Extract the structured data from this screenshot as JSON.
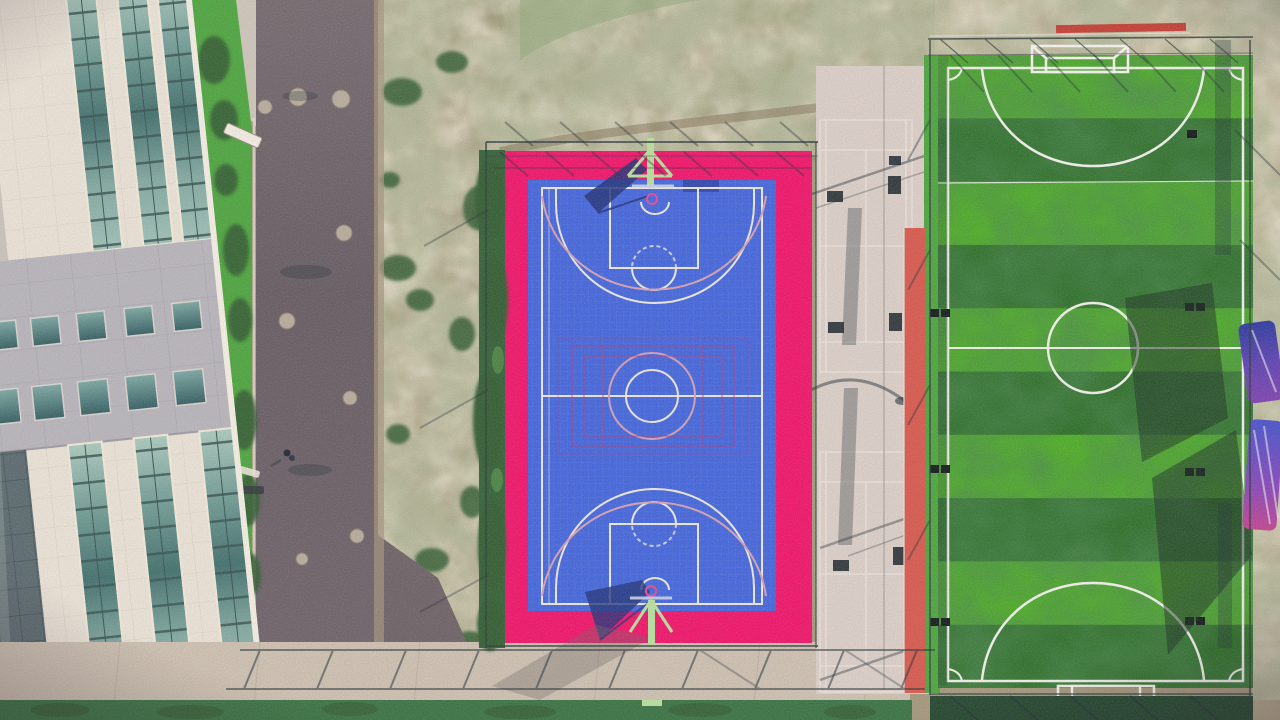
{
  "scene": {
    "description-regions": [
      "office-building",
      "access-road",
      "scrub-ground",
      "basketball-court",
      "badminton-strip",
      "soccer-field"
    ],
    "text_content": "none"
  },
  "colors": {
    "scrub-tan": "#a2967a",
    "scrub-olive": "#90906b",
    "dirt-light": "#b3a68a",
    "pavement-light": "#cdc5b8",
    "concrete-walk": "#c9bcab",
    "concrete-strip": "#d8ccc4",
    "court-pink": "#f00f67",
    "court-blue": "#3f63dc",
    "court-line": "#ece9e1",
    "court-line-accent": "#d49fb0",
    "overlay-crimson": "#b23a78",
    "hoop-green": "#b7e09c",
    "hoop-ring-pink": "#e24a92",
    "backboard-shadow": "#1d2e78",
    "hedge-green": "#35703f",
    "lawn-green": "#49a43b",
    "bush-green": "#2f5a2e",
    "field-light": "#49b21f",
    "field-dark": "#256e20",
    "field-line": "#f0f1ea",
    "track-red": "#d7564a",
    "banner-red": "#c23b31",
    "fence-dark": "#2a3a38",
    "shadow-dark": "#1c2b33",
    "building-cream": "#eae3d6",
    "building-gray": "#b6b4ba",
    "glazed-dark": "#57676b",
    "goal-white": "#f6f5f0",
    "object-blue": "#3450c0",
    "object-purple": "#8d3fae",
    "object-magenta": "#c2408e"
  }
}
